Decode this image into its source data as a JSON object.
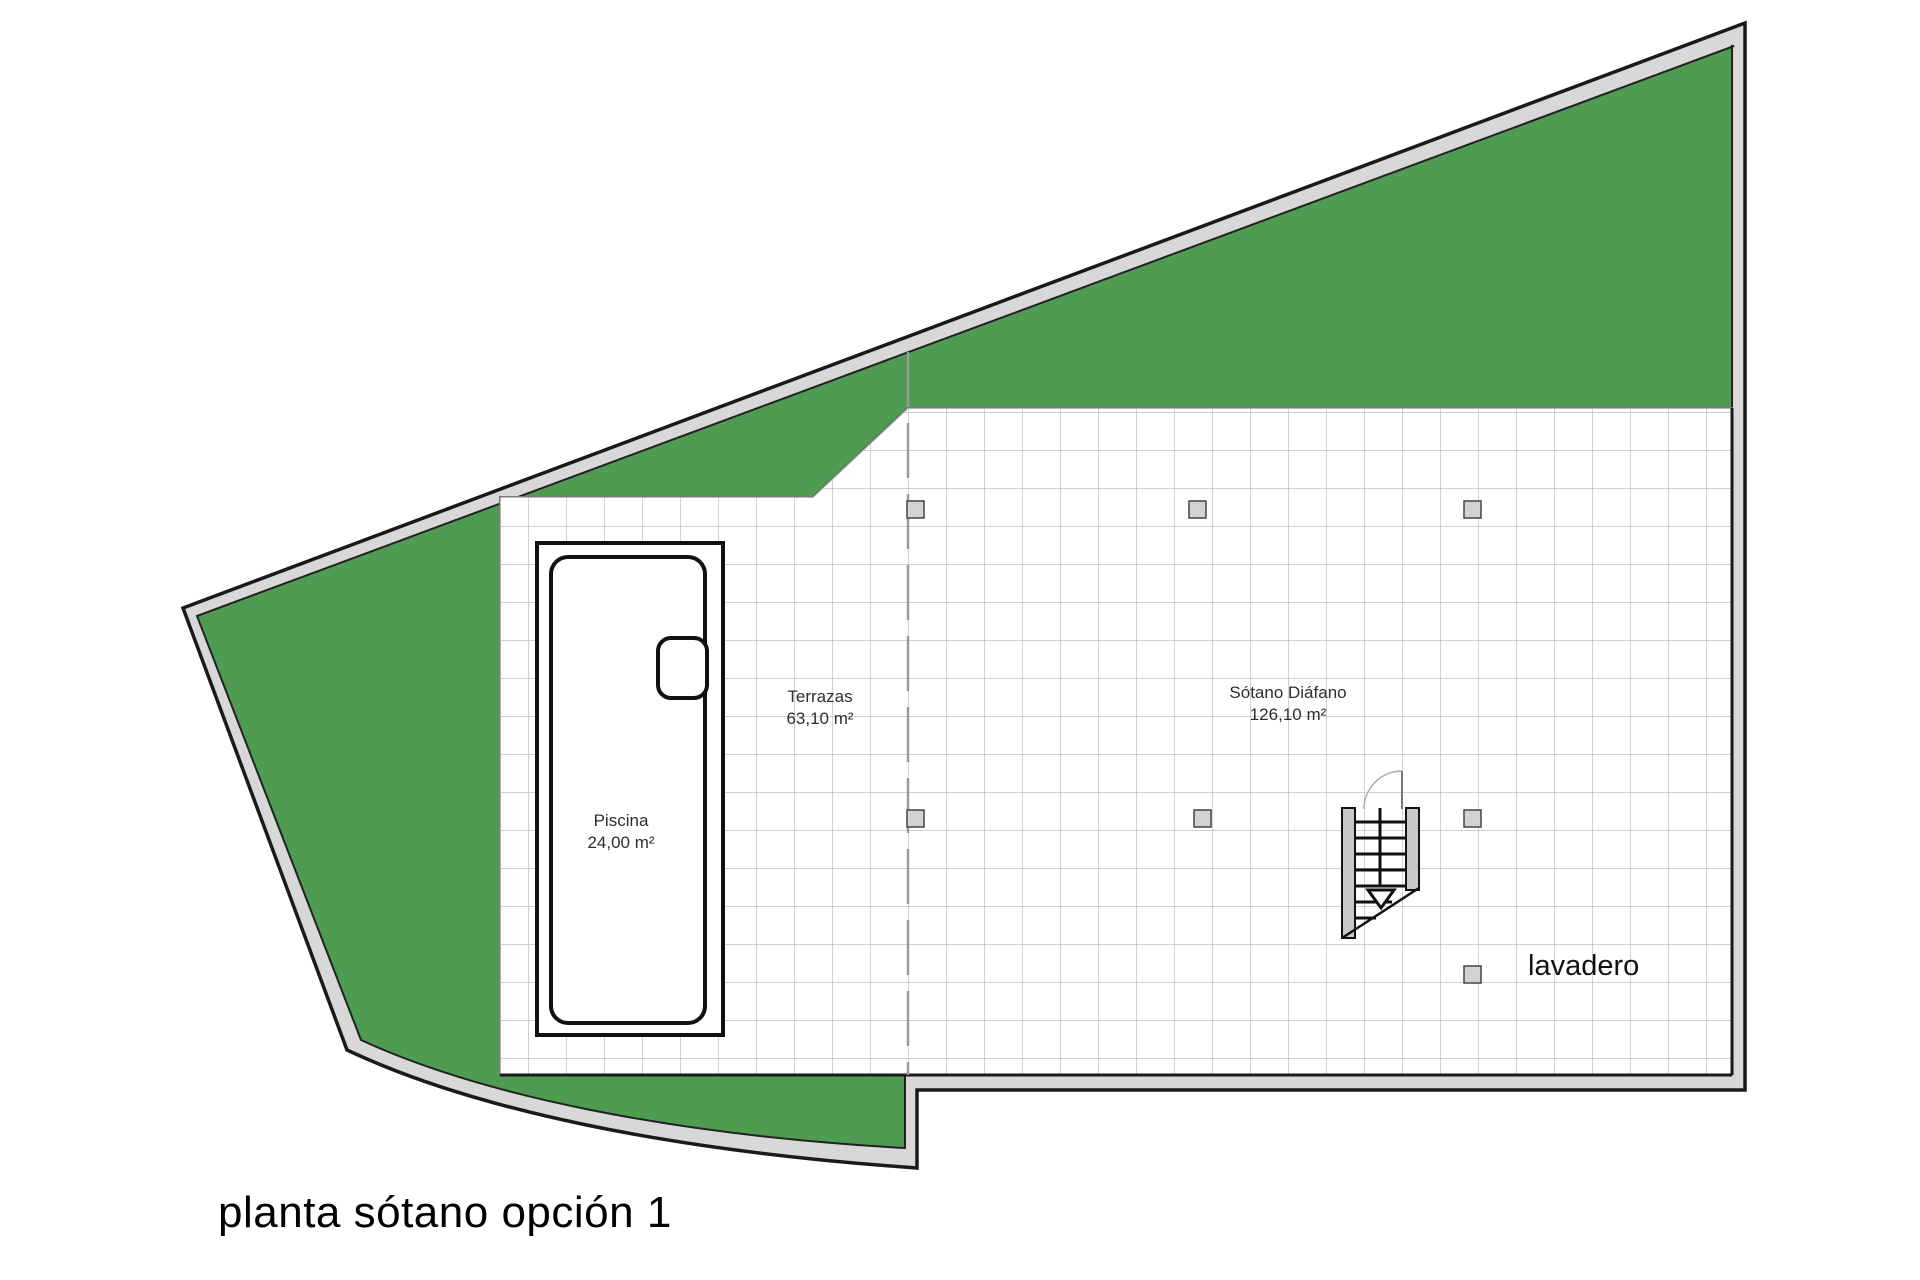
{
  "title": "planta sótano opción 1",
  "labels": {
    "terrace_name": "Terrazas",
    "terrace_area": "63,10 m²",
    "basement_name": "Sótano Diáfano",
    "basement_area": "126,10 m²",
    "pool_name": "Piscina",
    "pool_area": "24,00 m²",
    "laundry": "lavadero"
  },
  "colors": {
    "garden_green": "#4f9b51",
    "wall_gray": "#d8d8d8",
    "tile_grid_gray": "#b3b3b3",
    "line_black": "#1a1a1a",
    "column_gray": "#d2d2d2"
  }
}
